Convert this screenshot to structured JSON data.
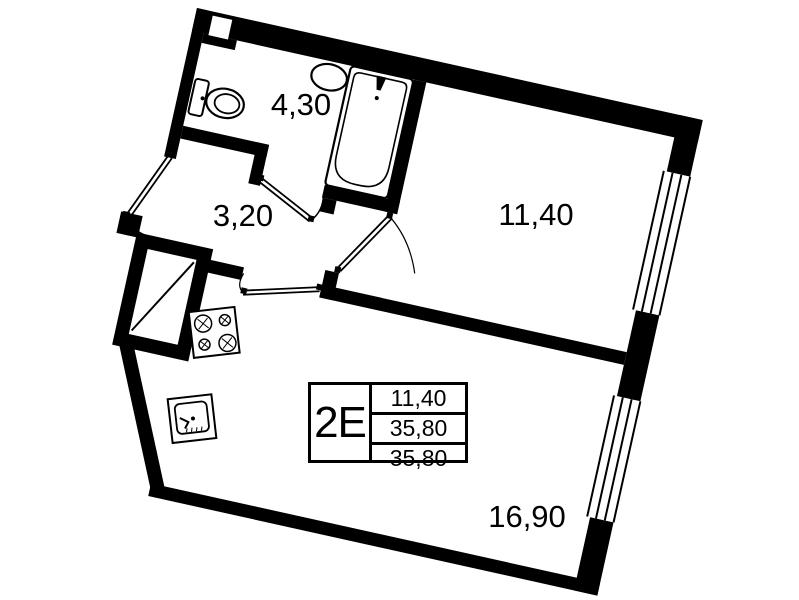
{
  "title": "Apartment floor plan 2E",
  "rooms": [
    {
      "id": "bathroom",
      "area_label": "4,30"
    },
    {
      "id": "hallway",
      "area_label": "3,20"
    },
    {
      "id": "room",
      "area_label": "11,40"
    },
    {
      "id": "kitchen_living",
      "area_label": "16,90"
    }
  ],
  "info_table": {
    "unit_type": "2Е",
    "values": [
      "11,40",
      "35,80",
      "35,80"
    ]
  },
  "fixtures": [
    "toilet",
    "wash-basin",
    "bathtub",
    "stove",
    "kitchen-sink",
    "ventilation-shaft"
  ],
  "colors": {
    "walls": "#000000",
    "background": "#ffffff",
    "text": "#000000"
  }
}
